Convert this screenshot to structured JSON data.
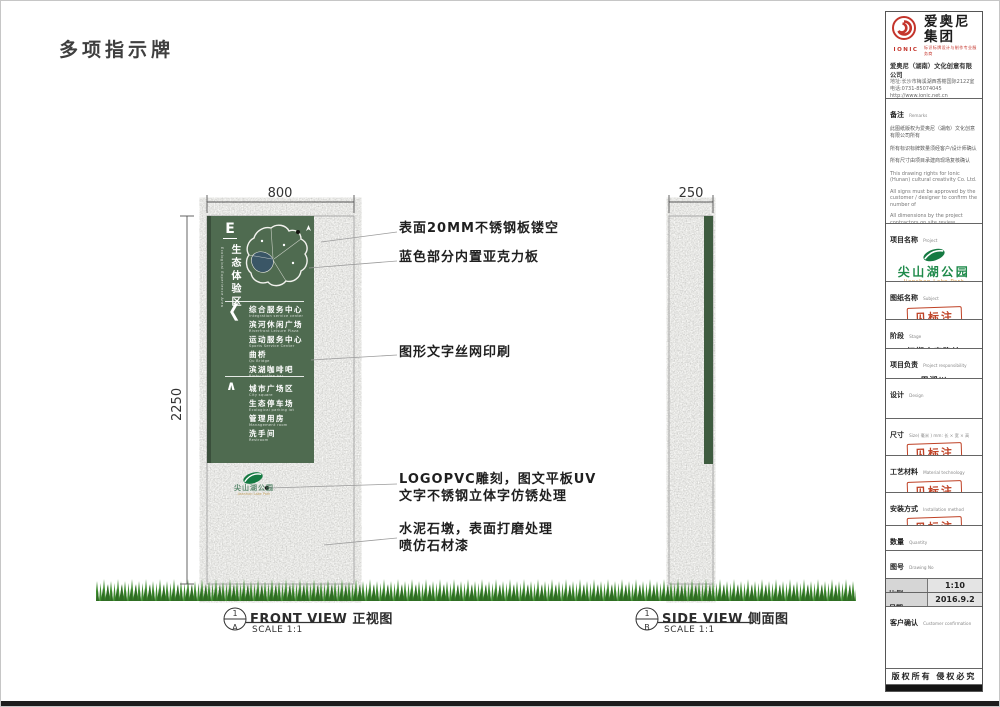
{
  "page": {
    "title": "多项指示牌"
  },
  "dims": {
    "front_width": "800",
    "height": "2250",
    "side_width": "250"
  },
  "annotations": [
    {
      "line1": "表面20MM不锈钢板镂空"
    },
    {
      "line1": "蓝色部分内置亚克力板"
    },
    {
      "line1": "图形文字丝网印刷"
    },
    {
      "line1": "LOGOPVC雕刻，图文平板UV",
      "line2": "文字不锈钢立体字仿锈处理"
    },
    {
      "line1": "水泥石墩，表面打磨处理",
      "line2": "喷仿石材漆"
    }
  ],
  "sign": {
    "zone_letter": "E",
    "zone_name": "生态体验区",
    "zone_name_en": "Ecological Experience Area",
    "chevron": "❮",
    "up_arrow": "∧",
    "groups": [
      {
        "items": [
          {
            "zh": "综合服务中心",
            "en": "Integration service center"
          },
          {
            "zh": "滨河休闲广场",
            "en": "Riverfront Leisure Plaza"
          },
          {
            "zh": "运动服务中心",
            "en": "Sports Service Center"
          },
          {
            "zh": "曲桥",
            "en": "Qu Bridge"
          },
          {
            "zh": "滨湖咖啡吧",
            "en": "Binhu coffee bar"
          }
        ]
      },
      {
        "items": [
          {
            "zh": "城市广场区",
            "en": "City square"
          },
          {
            "zh": "生态停车场",
            "en": "Ecological parking lot"
          },
          {
            "zh": "管理用房",
            "en": "Management room"
          },
          {
            "zh": "洗手间",
            "en": "Restroom"
          }
        ]
      }
    ],
    "footer_logo": {
      "name": "尖山湖公园",
      "name_en": "Jianshan Lake Park"
    }
  },
  "views": [
    {
      "num": "1",
      "letter": "A",
      "name_en": "FRONT VIEW",
      "name_cn": "正视图",
      "scale": "SCALE 1:1"
    },
    {
      "num": "1",
      "letter": "B",
      "name_en": "SIDE VIEW",
      "name_cn": "侧面图",
      "scale": "SCALE 1:1"
    }
  ],
  "company": {
    "logo_text": "IONIC",
    "name": "爱奥尼集团",
    "tagline": "标识标牌设计与制作专业服务商",
    "fullname": "爱奥尼（湖南）文化创意有限公司",
    "address": "地址:长沙市梅溪湖西香榭国际2122室",
    "phone": "电话:0731-85074045",
    "website": "http://www.ionic.net.cn"
  },
  "titleblock": {
    "remarks": {
      "label": "备注",
      "label_en": "Remarks",
      "cn1": "此图纸版权为爱奥尼（湖南）文化创意有限公司所有",
      "cn2": "所有标识标牌数量须经客户/设计师确认",
      "cn3": "所有尺寸由项目承建商现场复核确认",
      "en1": "This drawing rights for Ionic (Hunan) cultural creativity Co. Ltd.",
      "en2": "All signs must be approved by the customer / designer to confirm the number of",
      "en3": "All dimensions by the project contractors on site review confirmed"
    },
    "project": {
      "label": "项目名称",
      "label_en": "Project",
      "value": "尖山湖公园",
      "value_en": "Jianshan Lake Park"
    },
    "subject": {
      "label": "图纸名称",
      "label_en": "Subject",
      "stamp": "见标注"
    },
    "stage": {
      "label": "阶段",
      "label_en": "Stage",
      "value": "初期方案确认"
    },
    "responsibility": {
      "label": "项目负责",
      "label_en": "Project responsibility",
      "value": "周湘川"
    },
    "design": {
      "label": "设计",
      "label_en": "Design"
    },
    "size": {
      "label": "尺寸",
      "label_en": "Size( 毫米 ) mm: 长 × 宽 × 高",
      "stamp": "见标注"
    },
    "material": {
      "label": "工艺材料",
      "label_en": "Material technology",
      "stamp": "见标注"
    },
    "install": {
      "label": "安装方式",
      "label_en": "Installation method",
      "stamp": "见标注"
    },
    "quantity": {
      "label": "数量",
      "label_en": "Quantity"
    },
    "drawing_no": {
      "label": "图号",
      "label_en": "Drawing No"
    },
    "proportion": {
      "label": "比例",
      "label_en": "Proportion",
      "value": "1:10"
    },
    "date": {
      "label": "日期",
      "label_en": "Date",
      "value": "2016.9.2"
    },
    "customer": {
      "label": "客户确认",
      "label_en": "Customer confirmation"
    },
    "copyright": "版权所有  侵权必究"
  },
  "colors": {
    "sign_green": "#4f6b50",
    "sign_green_dark": "#3a4f3b",
    "side_strip_green": "#3f5c40",
    "grass_light": "#3e8c2f",
    "grass_dark": "#2f6d23",
    "stamp_red": "#bf4226",
    "brand_red": "#c4342b",
    "park_green": "#157a42",
    "park_orange": "#d99a3f"
  }
}
